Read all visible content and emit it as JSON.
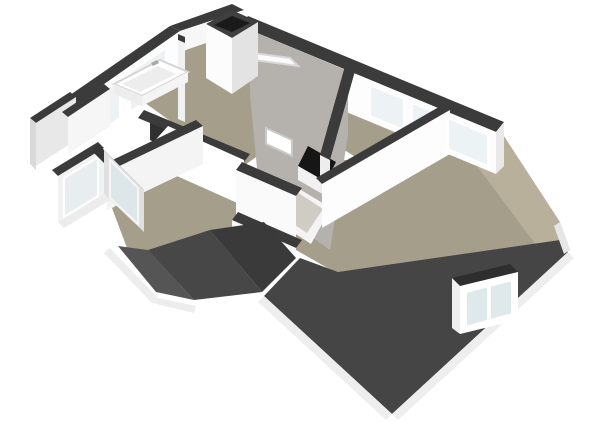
{
  "meta": {
    "kind": "3d-floorplan-render",
    "view": "isometric-perspective",
    "background": "#ffffff",
    "visible_text": ""
  },
  "palette": {
    "floor": "#a49e8b",
    "terrace_floor": "#b8b09b",
    "roof_dark": "#454545",
    "roof_valley_dark": "#3a3a3a",
    "wall_white": "#fdfdfd",
    "wall_shaded": "#e3e3e3",
    "wall_cap": "#3b3b3b",
    "sloped_ceiling": "#b5b2ae",
    "glass": "#edf2f4",
    "fascia": "#eeeeee",
    "opening_black": "#161616"
  },
  "features": [
    {
      "id": "bathroom",
      "label": "bathroom with bathtub and windows"
    },
    {
      "id": "chimney",
      "label": "chimney block"
    },
    {
      "id": "stairwell",
      "label": "stair opening with balustrade"
    },
    {
      "id": "skylights",
      "label": "skylights on sloped ceiling"
    },
    {
      "id": "bedrooms",
      "label": "rooms along windowed wall"
    },
    {
      "id": "main-room",
      "label": "large bottom-right room"
    },
    {
      "id": "dormer",
      "label": "dormer window on front roof"
    },
    {
      "id": "hip-roof",
      "label": "dark hip roof slopes with white fascia"
    },
    {
      "id": "window-bay",
      "label": "canted window bay on left"
    }
  ],
  "scene": {
    "width": 600,
    "height": 424,
    "polygons": [
      {
        "name": "floor-left-wing",
        "fill": "#a49e8b",
        "points": "130,92 226,20 338,98 238,170"
      },
      {
        "name": "floor-right-wing",
        "fill": "#a49e8b",
        "points": "250,36 495,140 425,202 298,120"
      },
      {
        "name": "floor-main-room",
        "fill": "#a49e8b",
        "points": "298,166 442,148 500,132 553,216 560,242 338,274 296,250 292,198"
      },
      {
        "name": "floor-left-room",
        "fill": "#a49e8b",
        "points": "112,208 192,162 278,238 198,294 130,256"
      },
      {
        "name": "floor-terrace",
        "fill": "#b8b09b",
        "points": "500,130 560,222 570,250 543,254 474,162"
      },
      {
        "name": "wall-cap-topright",
        "fill": "#3b3b3b",
        "points": "248,16 504,122 496,132 240,26"
      },
      {
        "name": "wall-face-topright",
        "fill": "#fdfdfd",
        "points": "240,26 496,132 496,174 240,68"
      },
      {
        "name": "ceiling-slope",
        "fill": "#b5b2ae",
        "points": "250,30 348,71 348,135 330,250 260,200 250,95"
      },
      {
        "name": "skylight-open-sash",
        "fill": "#fbfbfb",
        "stroke": "#d8d8d8",
        "points": "246,52 290,58 298,66 254,60"
      },
      {
        "name": "stairwell-opening",
        "fill": "#161616",
        "points": "308,146 336,162 326,182 298,166"
      },
      {
        "name": "stair-balustrade",
        "fill": "#f1f1f1",
        "points": "298,166 326,182 326,196 298,180"
      },
      {
        "name": "skylight-frame",
        "fill": "#f4f4f4",
        "points": "291,184 331,208 311,244 273,219"
      },
      {
        "name": "skylight-glass",
        "fill": "#cfccc6",
        "points": "297,192 323,209 307,233 283,217"
      },
      {
        "name": "window-right-1",
        "fill": "#edf2f4",
        "stroke": "#ffffff",
        "points": "370,85 404,99 404,130 370,116"
      },
      {
        "name": "window-right-2",
        "fill": "#edf2f4",
        "stroke": "#ffffff",
        "points": "412,103 432,111 432,142 412,134"
      },
      {
        "name": "wall-divider-cap-1",
        "fill": "#3b3b3b",
        "points": "345,66 355,71 330,160 320,155"
      },
      {
        "name": "wall-divider-face-1",
        "fill": "#ededed",
        "points": "320,155 330,160 330,196 320,191"
      },
      {
        "name": "wall-mainroom-cap",
        "fill": "#3b3b3b",
        "points": "316,178 444,104 450,110 322,184"
      },
      {
        "name": "wall-mainroom-face",
        "fill": "#fdfdfd",
        "points": "322,184 450,110 450,154 322,228"
      },
      {
        "name": "window-right-3",
        "fill": "#edf2f4",
        "stroke": "#ffffff",
        "points": "448,118 488,135 488,166 448,149"
      },
      {
        "name": "wall-end-right",
        "fill": "#e9e9e9",
        "points": "496,132 504,122 504,166 496,174"
      },
      {
        "name": "wall-cap-topleft",
        "fill": "#3b3b3b",
        "points": "60,102 170,26 180,31 70,108"
      },
      {
        "name": "wall-face-topleft",
        "fill": "#fdfdfd",
        "points": "70,108 180,31 180,74 70,150"
      },
      {
        "name": "window-bath-1",
        "fill": "#eef2f4",
        "stroke": "#ffffff",
        "points": "86,102 120,79 120,118 86,141"
      },
      {
        "name": "window-bath-2",
        "fill": "#eef2f4",
        "stroke": "#ffffff",
        "points": "130,72 166,48 166,88 130,112"
      },
      {
        "name": "wall-cap-top",
        "fill": "#3b3b3b",
        "points": "170,26 232,4 244,10 180,31"
      },
      {
        "name": "wall-face-top",
        "fill": "#f7f7f7",
        "points": "180,31 244,10 244,30 180,52"
      },
      {
        "name": "wall-bath-partition-cap",
        "fill": "#3b3b3b",
        "points": "178,34 185,37 185,43 178,40"
      },
      {
        "name": "wall-bath-partition-face",
        "fill": "#f1f1f1",
        "points": "178,40 185,43 185,122 178,119"
      },
      {
        "name": "chimney-cap",
        "fill": "#3f3f3f",
        "points": "206,24 232,10 258,22 232,38"
      },
      {
        "name": "chimney-flue",
        "fill": "#1a1a1a",
        "points": "214,25 232,16 250,23 232,32"
      },
      {
        "name": "chimney-face-left",
        "fill": "#fcfcfc",
        "points": "206,24 232,38 232,94 206,78"
      },
      {
        "name": "chimney-face-right",
        "fill": "#e3e3e3",
        "points": "232,38 258,22 258,76 232,94"
      },
      {
        "name": "wall-left-outer-cap",
        "fill": "#3b3b3b",
        "points": "30,118 70,92 76,97 36,123"
      },
      {
        "name": "wall-left-outer-face",
        "fill": "#e8e8e8",
        "points": "36,123 76,97 76,140 36,166"
      },
      {
        "name": "wall-left-outer-side",
        "fill": "#d9d9d9",
        "points": "30,118 36,123 36,170 30,164"
      },
      {
        "name": "wall-hall-cap",
        "fill": "#3b3b3b",
        "points": "62,112 104,84 110,89 68,117"
      },
      {
        "name": "wall-hall-face",
        "fill": "#f6f6f6",
        "points": "68,117 110,89 110,126 68,154"
      },
      {
        "name": "wall-stair-dark-corner",
        "fill": "#2f2f2f",
        "points": "150,118 172,128 172,150 150,140"
      },
      {
        "name": "wall-stair-cap",
        "fill": "#3b3b3b",
        "points": "144,110 250,154 244,162 138,118"
      },
      {
        "name": "wall-stair-face",
        "fill": "#ffffff",
        "points": "168,126 244,160 244,206 150,164 150,146"
      },
      {
        "name": "door-panel",
        "fill": "#ffffff",
        "stroke": "#c9c9c9",
        "points": "266,128 292,140 292,156 266,144"
      },
      {
        "name": "wall-corridor-cap",
        "fill": "#3b3b3b",
        "points": "242,162 302,188 296,196 236,170"
      },
      {
        "name": "wall-corridor-face",
        "fill": "#fafafa",
        "points": "236,170 296,196 296,240 236,214"
      },
      {
        "name": "wall-corridor2-cap",
        "fill": "#3b3b3b",
        "points": "238,212 302,240 296,248 232,220"
      },
      {
        "name": "wall-corridor2-face",
        "fill": "#f8f8f8",
        "points": "232,220 296,248 296,270 232,242"
      },
      {
        "name": "wall-leftroom-cap",
        "fill": "#3b3b3b",
        "points": "100,166 196,120 203,126 107,172"
      },
      {
        "name": "wall-leftroom-face",
        "fill": "#f4f4f4",
        "points": "107,172 203,126 203,164 107,210"
      },
      {
        "name": "bay-cap-1",
        "fill": "#3b3b3b",
        "points": "52,170 98,142 104,148 58,176"
      },
      {
        "name": "bay-face-1",
        "fill": "#f2f2f2",
        "points": "58,176 104,148 104,194 58,222"
      },
      {
        "name": "bay-window-1",
        "fill": "#e8eef0",
        "stroke": "#ffffff",
        "points": "64,178 98,157 98,196 64,217"
      },
      {
        "name": "bay-cap-2",
        "fill": "#363636",
        "points": "98,144 144,190 138,197 92,151"
      },
      {
        "name": "bay-face-2",
        "fill": "#e0e0e0",
        "points": "104,150 144,190 144,232 104,194"
      },
      {
        "name": "bay-window-2",
        "fill": "#dde6e9",
        "stroke": "#f5f5f5",
        "points": "110,160 138,188 138,224 110,198"
      },
      {
        "name": "bay-fascia",
        "fill": "#ececec",
        "points": "58,222 104,194 110,200 64,228"
      },
      {
        "name": "bathtub-rim",
        "fill": "#ffffff",
        "stroke": "#d5d5d5",
        "points": "114,84 160,60 188,72 142,96"
      },
      {
        "name": "bathtub-basin",
        "fill": "#ededed",
        "points": "122,84 158,66 176,74 140,92"
      },
      {
        "name": "bathtub-front-left",
        "fill": "#ededed",
        "points": "114,84 142,96 142,106 114,94"
      },
      {
        "name": "bathtub-front-right",
        "fill": "#f4f4f4",
        "points": "142,96 188,72 188,82 142,106"
      },
      {
        "name": "bathtub-faucet",
        "fill": "#a8a8a8",
        "points": "151,63 157,60 159,63 153,66"
      },
      {
        "name": "roof-valley-3",
        "fill": "#555555",
        "points": "118,246 148,250 194,300 156,292"
      },
      {
        "name": "roof-valley-1",
        "fill": "#474747",
        "points": "148,250 210,230 262,292 194,300"
      },
      {
        "name": "roof-valley-2",
        "fill": "#3a3a3a",
        "points": "210,230 264,222 296,258 262,292"
      },
      {
        "name": "fascia-valley-left",
        "fill": "#ededed",
        "points": "110,248 158,298 152,303 104,253"
      },
      {
        "name": "fascia-valley-right",
        "fill": "#ededed",
        "points": "158,298 196,306 194,313 152,303"
      },
      {
        "name": "roof-main",
        "fill": "#454545",
        "points": "300,258 338,272 560,240 568,252 392,414 264,296"
      },
      {
        "name": "fascia-main-left",
        "fill": "#eeeeee",
        "points": "264,296 392,414 386,420 258,302"
      },
      {
        "name": "fascia-main-right",
        "fill": "#eeeeee",
        "points": "392,414 568,252 574,258 398,420"
      },
      {
        "name": "fascia-terrace",
        "fill": "#e6e6e6",
        "points": "560,222 570,250 564,254 554,226"
      },
      {
        "name": "dormer-roof",
        "fill": "#2e2e2e",
        "points": "452,278 510,264 518,272 460,286"
      },
      {
        "name": "dormer-face-left",
        "fill": "#f0f0f0",
        "points": "452,278 460,286 460,334 452,328"
      },
      {
        "name": "dormer-face-front",
        "fill": "#ffffff",
        "points": "460,286 518,272 518,320 460,334"
      },
      {
        "name": "dormer-window",
        "fill": "#dfe9ec",
        "stroke": "#ffffff",
        "points": "466,292 512,280 512,314 466,327"
      },
      {
        "name": "dormer-window-mullion",
        "fill": "#ffffff",
        "points": "487,286 491,285 491,321 487,322"
      }
    ]
  }
}
